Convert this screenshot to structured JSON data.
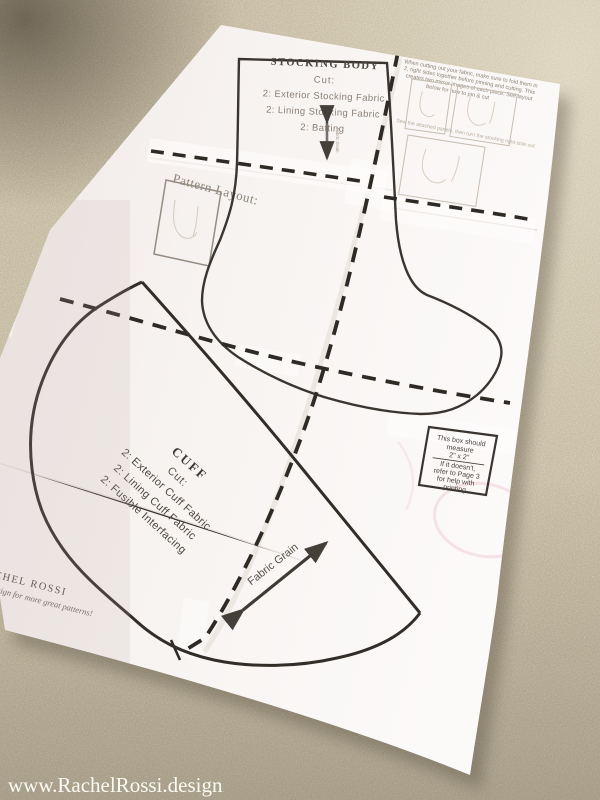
{
  "page": {
    "watermark": "www.RachelRossi.design"
  },
  "stocking_body": {
    "title": "STOCKING BODY",
    "cut_label": "Cut:",
    "cut_lines": [
      "2: Exterior Stocking Fabric",
      "2: Lining Stocking Fabric",
      "2: Batting"
    ],
    "grain_label": "Fabric Grain"
  },
  "cuff": {
    "title": "CUFF",
    "cut_label": "Cut:",
    "cut_lines": [
      "2: Exterior Cuff Fabric",
      "2: Lining Cuff Fabric",
      "2: Fusible Interfacing"
    ],
    "grain_label": "Fabric Grain"
  },
  "pattern_layout": {
    "label": "Pattern Layout:"
  },
  "instructions": {
    "lines": [
      "When cutting out your fabric, make sure to fold them in",
      "2, right sides together before pinning and cutting. This",
      "creates two mirror images of each piece. See layout",
      "below for how to pin & cut"
    ],
    "caption": "Sew the attached panels, then turn the stocking right-side out"
  },
  "measure_box": {
    "lines": [
      "This box should",
      "measure",
      "2\" x 2\"",
      "If it doesn't,",
      "refer to Page 3",
      "for help with",
      "printing"
    ]
  },
  "branding": {
    "name": "RACHEL ROSSI",
    "tagline": "rachelrossi.design for more great patterns!"
  },
  "colors": {
    "ink": "#35302b",
    "muted_ink": "#8a8077",
    "paper": "#f7f3f1",
    "carpet": "#c7bca4",
    "pink_mark": "#eec6d0",
    "watermark": "#fffef9"
  }
}
